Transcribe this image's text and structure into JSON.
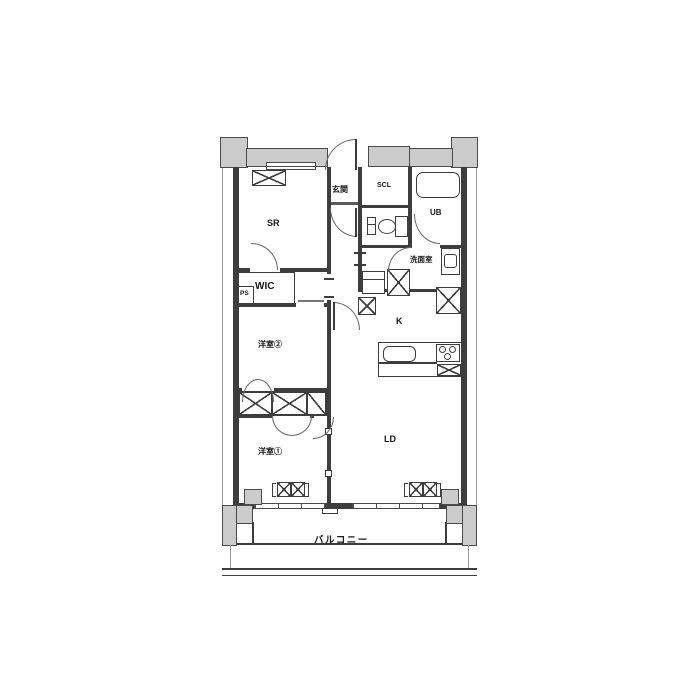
{
  "plan": {
    "title": "apartment-floor-plan",
    "labels": {
      "sr": "SR",
      "genkan": "玄関",
      "scl": "SCL",
      "ub": "UB",
      "senmenshitsu": "洗面室",
      "wic": "WIC",
      "ps": "PS",
      "youshitsu2": "洋室②",
      "kitchen": "K",
      "ld": "LD",
      "youshitsu1": "洋室①",
      "balcony": "バルコニー"
    },
    "colors": {
      "wall_fill": "#cbcbcb",
      "line": "#3d3d3d",
      "background": "#ffffff"
    }
  }
}
